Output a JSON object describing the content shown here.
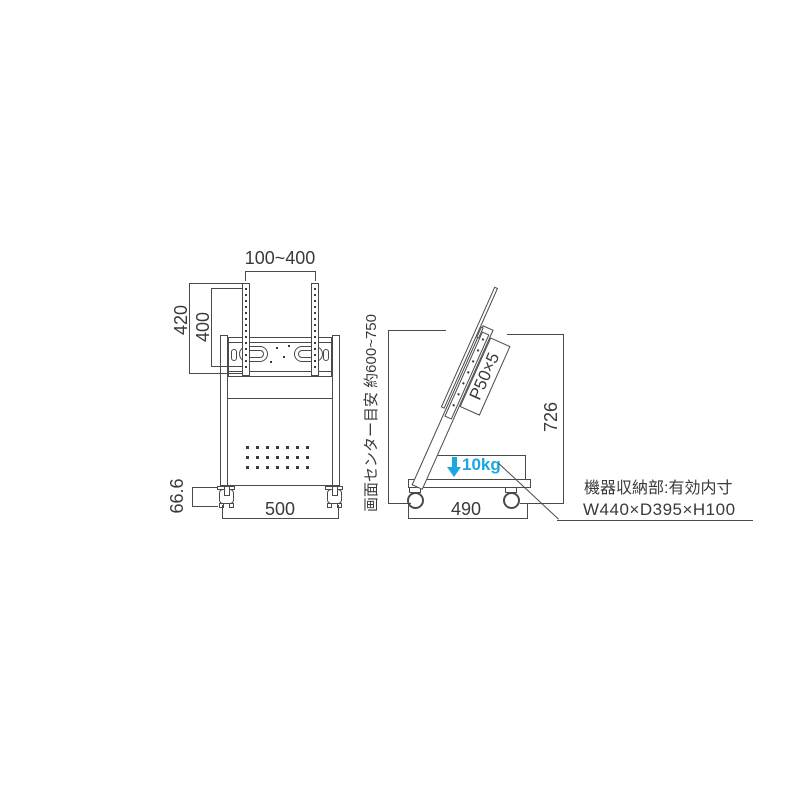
{
  "front_view": {
    "dim_mount_width": "100~400",
    "dim_bracket_height": "420",
    "dim_hole_span": "400",
    "dim_caster_height": "66.6",
    "dim_body_width": "500"
  },
  "side_view": {
    "dim_screen_center": "画面センター目安 約600~750",
    "label_hole_pitch": "P50×5",
    "dim_total_height": "726",
    "shelf_load_label": "10kg",
    "dim_base_depth": "490"
  },
  "annotation": {
    "line1": "機器収納部:有効内寸",
    "line2": "W440×D395×H100"
  },
  "colors": {
    "line": "#4a4a4a",
    "text": "#3a3a3a",
    "accent": "#1ba7e0"
  }
}
